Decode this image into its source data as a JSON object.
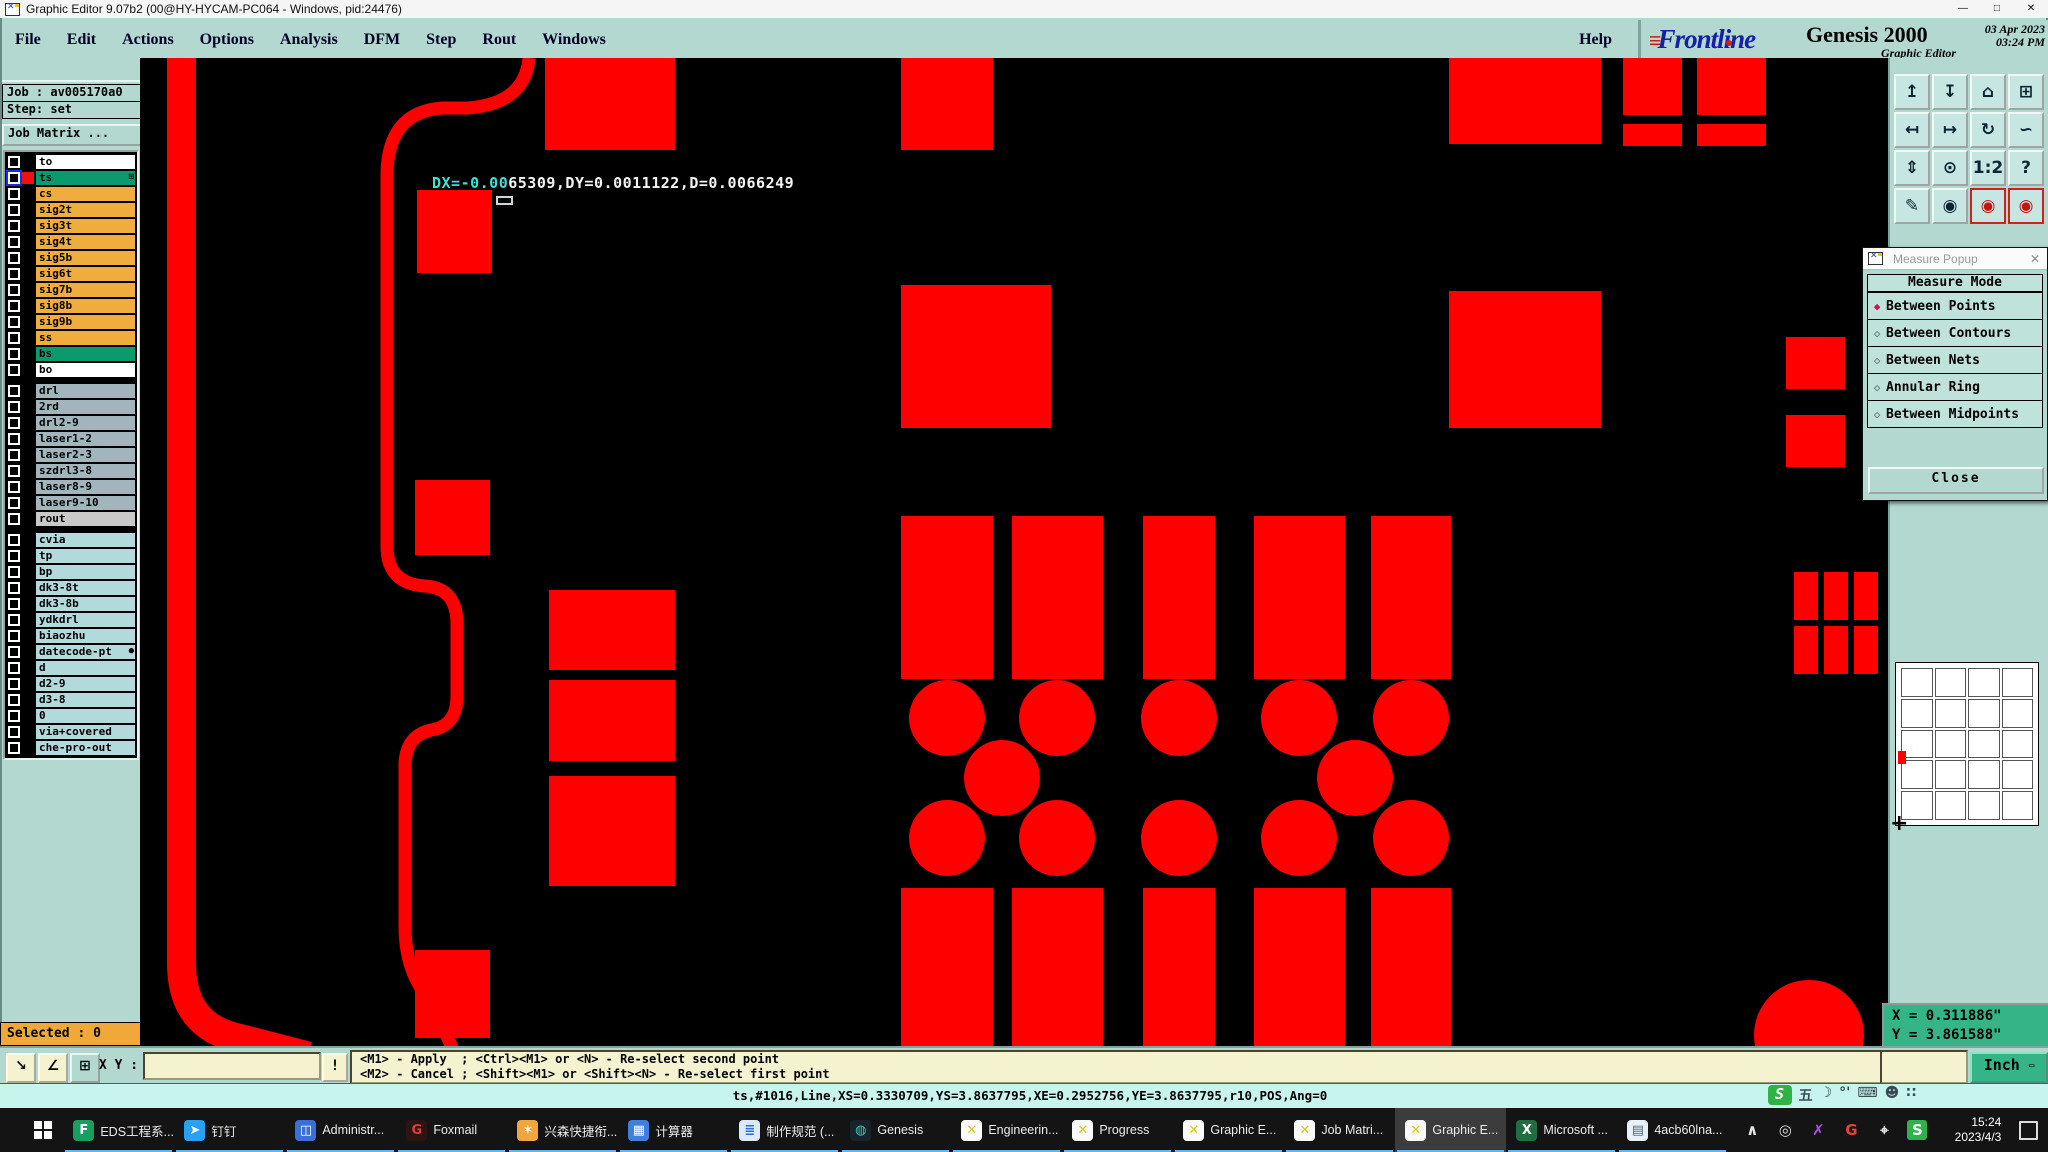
{
  "window": {
    "title": "Graphic Editor 9.07b2 (00@HY-HYCAM-PC064 - Windows, pid:24476)",
    "min": "—",
    "max": "□",
    "close": "✕"
  },
  "menu": {
    "items": [
      "File",
      "Edit",
      "Actions",
      "Options",
      "Analysis",
      "DFM",
      "Step",
      "Rout",
      "Windows"
    ],
    "help": "Help"
  },
  "brand": {
    "bars": "≡",
    "logo": "Frontline",
    "product": "Genesis 2000",
    "date": "03 Apr 2023",
    "time": "03:24 PM",
    "app": "Graphic Editor"
  },
  "sidebar": {
    "job_label": "Job : av005170a0",
    "step_label": "Step: set",
    "matrix_button": "Job Matrix ...",
    "selected_label": "Selected : 0",
    "layers1": [
      {
        "name": "to",
        "bg": "#ffffff",
        "swatch": "#000000"
      },
      {
        "name": "ts",
        "bg": "#0b9a70",
        "swatch": "#ee1111",
        "selected": true,
        "suffix": "⊞"
      },
      {
        "name": "cs",
        "bg": "#f0ac3c",
        "swatch": "#000000"
      },
      {
        "name": "sig2t",
        "bg": "#f0ac3c",
        "swatch": "#000000"
      },
      {
        "name": "sig3t",
        "bg": "#f0ac3c",
        "swatch": "#000000"
      },
      {
        "name": "sig4t",
        "bg": "#f0ac3c",
        "swatch": "#000000"
      },
      {
        "name": "sig5b",
        "bg": "#f0ac3c",
        "swatch": "#000000"
      },
      {
        "name": "sig6t",
        "bg": "#f0ac3c",
        "swatch": "#000000"
      },
      {
        "name": "sig7b",
        "bg": "#f0ac3c",
        "swatch": "#000000"
      },
      {
        "name": "sig8b",
        "bg": "#f0ac3c",
        "swatch": "#000000"
      },
      {
        "name": "sig9b",
        "bg": "#f0ac3c",
        "swatch": "#000000"
      },
      {
        "name": "ss",
        "bg": "#f0ac3c",
        "swatch": "#000000"
      },
      {
        "name": "bs",
        "bg": "#0b9a70",
        "swatch": "#000000"
      },
      {
        "name": "bo",
        "bg": "#ffffff",
        "swatch": "#000000"
      }
    ],
    "layers2": [
      {
        "name": "drl",
        "bg": "#a2b4bc",
        "swatch": "#000000"
      },
      {
        "name": "2rd",
        "bg": "#a2b4bc",
        "swatch": "#000000"
      },
      {
        "name": "drl2-9",
        "bg": "#a2b4bc",
        "swatch": "#000000"
      },
      {
        "name": "laser1-2",
        "bg": "#a2b4bc",
        "swatch": "#000000"
      },
      {
        "name": "laser2-3",
        "bg": "#a2b4bc",
        "swatch": "#000000"
      },
      {
        "name": "szdrl3-8",
        "bg": "#a2b4bc",
        "swatch": "#000000"
      },
      {
        "name": "laser8-9",
        "bg": "#a2b4bc",
        "swatch": "#000000"
      },
      {
        "name": "laser9-10",
        "bg": "#a2b4bc",
        "swatch": "#000000"
      },
      {
        "name": "rout",
        "bg": "#c9c9c9",
        "swatch": "#000000"
      }
    ],
    "layers3": [
      {
        "name": "cvia",
        "bg": "#b2dadc",
        "swatch": "#000000"
      },
      {
        "name": "tp",
        "bg": "#b2dadc",
        "swatch": "#000000"
      },
      {
        "name": "bp",
        "bg": "#b2dadc",
        "swatch": "#000000"
      },
      {
        "name": "dk3-8t",
        "bg": "#b2dadc",
        "swatch": "#000000"
      },
      {
        "name": "dk3-8b",
        "bg": "#b2dadc",
        "swatch": "#000000"
      },
      {
        "name": "ydkdrl",
        "bg": "#b2dadc",
        "swatch": "#000000"
      },
      {
        "name": "biaozhu",
        "bg": "#b2dadc",
        "swatch": "#000000"
      },
      {
        "name": "datecode-pt",
        "bg": "#b2dadc",
        "swatch": "#000000",
        "suffix": "●"
      },
      {
        "name": "d",
        "bg": "#b2dadc",
        "swatch": "#000000"
      },
      {
        "name": "d2-9",
        "bg": "#b2dadc",
        "swatch": "#000000"
      },
      {
        "name": "d3-8",
        "bg": "#b2dadc",
        "swatch": "#000000"
      },
      {
        "name": "0",
        "bg": "#b2dadc",
        "swatch": "#000000"
      },
      {
        "name": "via+covered",
        "bg": "#b2dadc",
        "swatch": "#000000"
      },
      {
        "name": "che-pro-out",
        "bg": "#b2dadc",
        "swatch": "#000000"
      }
    ]
  },
  "canvas": {
    "artwork_color": "#ff0000",
    "measure_text_cyan": "DX=-0.00",
    "measure_text_white": "65309,DY=0.0011122,D=0.0066249"
  },
  "right_toolbar": {
    "buttons": [
      {
        "glyph": "↥"
      },
      {
        "glyph": "↧"
      },
      {
        "glyph": "⌂"
      },
      {
        "glyph": "⊞"
      },
      {
        "glyph": "↤"
      },
      {
        "glyph": "↦"
      },
      {
        "glyph": "↻"
      },
      {
        "glyph": "∽"
      },
      {
        "glyph": "⇕"
      },
      {
        "glyph": "⊙"
      },
      {
        "glyph": "1:2"
      },
      {
        "glyph": "?"
      },
      {
        "glyph": "✎"
      },
      {
        "glyph": "◉"
      },
      {
        "glyph": "◉",
        "red": true
      },
      {
        "glyph": "◉",
        "red": true
      }
    ]
  },
  "measure_popup": {
    "title": "Measure Popup",
    "close_x": "✕",
    "header": "Measure Mode",
    "options": [
      {
        "label": "Between Points",
        "selected": true
      },
      {
        "label": "Between Contours"
      },
      {
        "label": "Between Nets"
      },
      {
        "label": "Annular Ring"
      },
      {
        "label": "Between Midpoints"
      }
    ],
    "close_button": "Close"
  },
  "coords": {
    "x_line": "X = 0.311886\"",
    "y_line": "Y = 3.861588\"",
    "units_button": "Inch"
  },
  "bottom_bar": {
    "tool1": "↘",
    "tool2": "∠",
    "tool3": "⊞",
    "xy_label": "X Y :",
    "input_value": "",
    "bang_button": "!",
    "hint1": "<M1> - Apply  ; <Ctrl><M1> or <N> - Re-select second point",
    "hint2": "<M2> - Cancel ; <Shift><M1> or <Shift><N> - Re-select first point"
  },
  "status_line": {
    "text": "ts,#1016,Line,XS=0.3330709,YS=3.8637795,XE=0.2952756,YE=3.8637795,r10,POS,Ang=0"
  },
  "ime": {
    "logo": "S",
    "items": [
      {
        "glyph": "五"
      },
      {
        "glyph": "☽"
      },
      {
        "glyph": "°'"
      },
      {
        "glyph": "⌨"
      },
      {
        "glyph": "☻"
      },
      {
        "glyph": "∷"
      }
    ]
  },
  "taskbar": {
    "items": [
      {
        "label": "EDS工程系...",
        "glyph": "F",
        "fg": "#ffffff",
        "bg": "#17a05d"
      },
      {
        "label": "钉钉",
        "glyph": "➤",
        "fg": "#ffffff",
        "bg": "#2aa0f2"
      },
      {
        "label": "Administr...",
        "glyph": "◫",
        "fg": "#ffffff",
        "bg": "#3a6fd8"
      },
      {
        "label": "Foxmail",
        "glyph": "G",
        "fg": "#e23d2e",
        "bg": "#2a1414"
      },
      {
        "label": "兴森快捷衔...",
        "glyph": "✶",
        "fg": "#ffffff",
        "bg": "#f0a63c"
      },
      {
        "label": "计算器",
        "glyph": "▦",
        "fg": "#ffffff",
        "bg": "#3f7fe0"
      },
      {
        "label": "制作规范 (...",
        "glyph": "≣",
        "fg": "#2a6fd0",
        "bg": "#dbe9fb"
      },
      {
        "label": "Genesis",
        "glyph": "◍",
        "fg": "#49c6b5",
        "bg": "#18242c"
      },
      {
        "label": "Engineerin...",
        "glyph": "✕",
        "fg": "#d8c920",
        "bg": "#fafafa"
      },
      {
        "label": "Progress",
        "glyph": "✕",
        "fg": "#d8c920",
        "bg": "#fafafa"
      },
      {
        "label": "Graphic E...",
        "glyph": "✕",
        "fg": "#d8c920",
        "bg": "#fafafa"
      },
      {
        "label": "Job Matri...",
        "glyph": "✕",
        "fg": "#d8c920",
        "bg": "#fafafa"
      },
      {
        "label": "Graphic E...",
        "glyph": "✕",
        "fg": "#d8c920",
        "bg": "#fafafa",
        "active": true
      },
      {
        "label": "Microsoft ...",
        "glyph": "X",
        "fg": "#ffffff",
        "bg": "#1d6f42"
      },
      {
        "label": "4acb60lna...",
        "glyph": "▤",
        "fg": "#556677",
        "bg": "#e8f0f8"
      }
    ],
    "tray": [
      {
        "glyph": "∧",
        "fg": "#e8e8e8"
      },
      {
        "glyph": "◎",
        "fg": "#dddddd"
      },
      {
        "glyph": "✗",
        "fg": "#b44fe0"
      },
      {
        "glyph": "G",
        "fg": "#e24334"
      },
      {
        "glyph": "⌖",
        "fg": "#e8e8e8"
      },
      {
        "glyph": "S",
        "fg": "#ffffff",
        "bg": "#2eb34a"
      }
    ],
    "clock_time": "15:24",
    "clock_date": "2023/4/3"
  }
}
